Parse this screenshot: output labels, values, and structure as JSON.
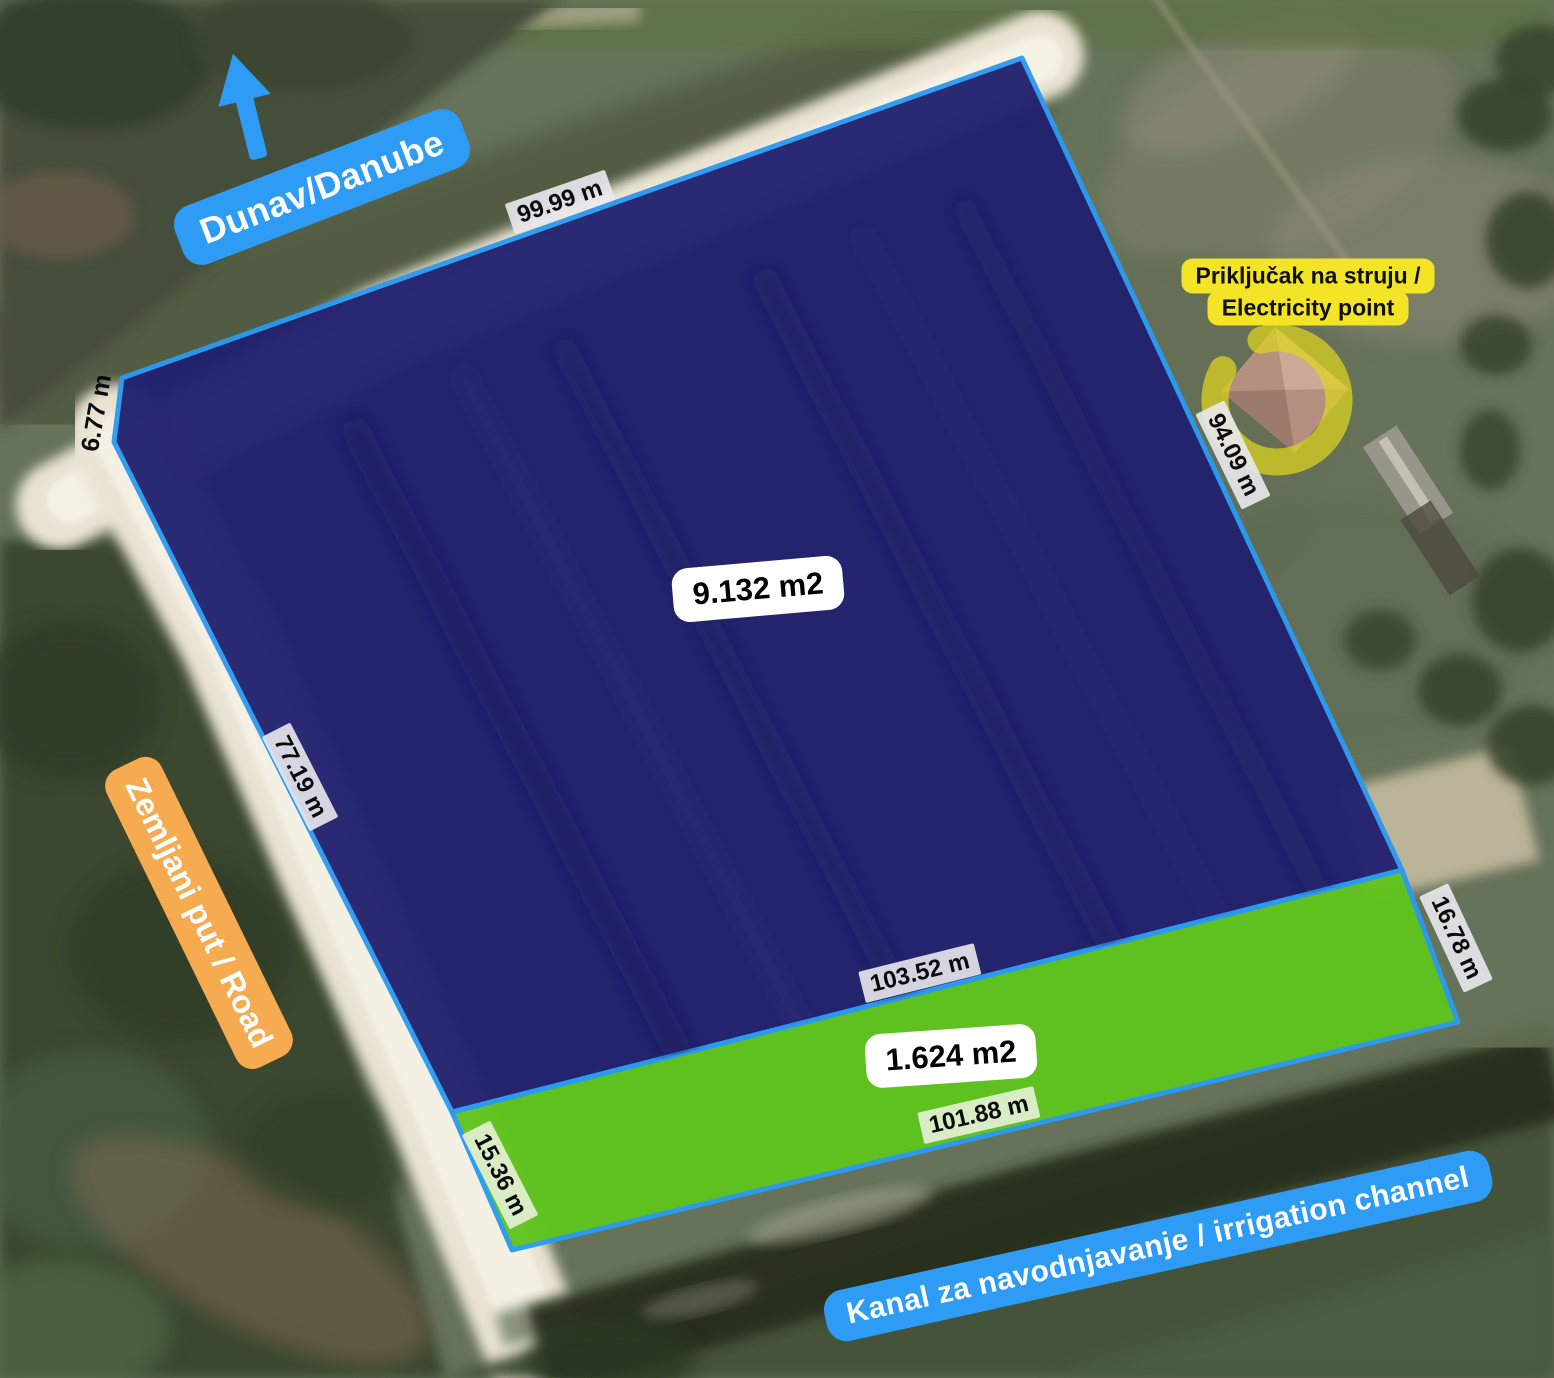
{
  "map": {
    "direction_labels": {
      "river": "Dunav/Danube",
      "road": "Zemljani put / Road",
      "canal": "Kanal za navodnjavanje / irrigation channel"
    },
    "electricity": {
      "line1": "Priključak na struju /",
      "line2": "Electricity point"
    },
    "parcels": {
      "main_area": "9.132 m2",
      "canal_strip_area": "1.624 m2"
    },
    "measurements": {
      "north_edge": "99.99 m",
      "northwest_corner": "6.77 m",
      "west_edge": "77.19 m",
      "east_edge": "94.09 m",
      "south_edge_main": "103.52 m",
      "south_edge_strip": "101.88 m",
      "strip_east_edge": "16.78 m",
      "strip_west_edge": "15.36 m"
    },
    "colors": {
      "parcel_fill": "#22216f",
      "parcel_border": "#2b9af0",
      "strip_fill": "#5fc41e",
      "river_label_bg": "#2e9cf4",
      "road_label_bg": "#f7ab50",
      "electricity_label_bg": "#f4e427",
      "electricity_ring": "#ded51f",
      "measure_label_bg": "#ebebee",
      "area_label_bg": "#ffffff"
    }
  }
}
